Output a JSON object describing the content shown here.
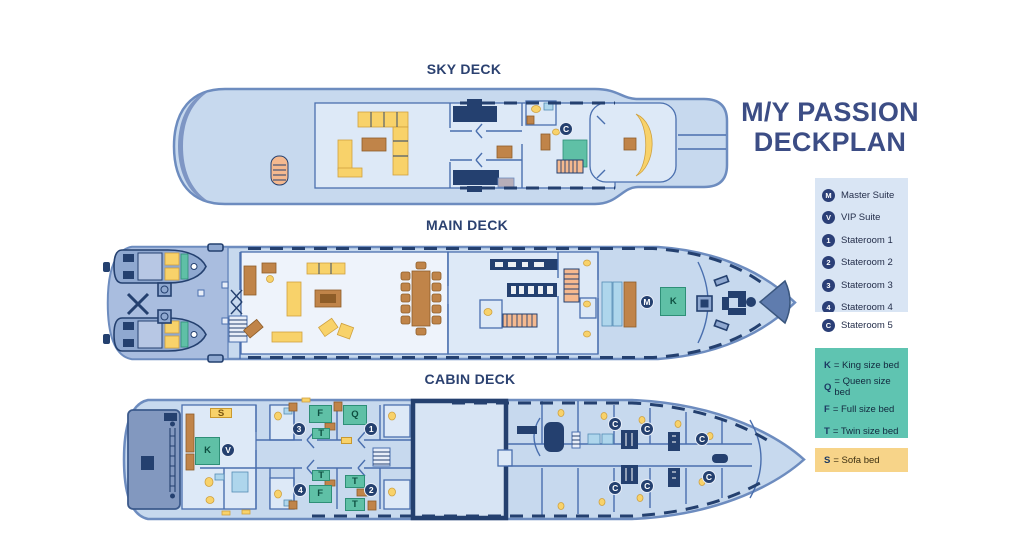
{
  "title": {
    "line1": "M/Y PASSION",
    "line2": "DECKPLAN"
  },
  "decks": [
    {
      "label": "SKY DECK"
    },
    {
      "label": "MAIN DECK"
    },
    {
      "label": "CABIN DECK"
    }
  ],
  "legend_staterooms": {
    "items": [
      {
        "icon": "M",
        "label": "Master Suite"
      },
      {
        "icon": "V",
        "label": "VIP Suite"
      },
      {
        "icon": "1",
        "label": "Stateroom 1"
      },
      {
        "icon": "2",
        "label": "Stateroom 2"
      },
      {
        "icon": "3",
        "label": "Stateroom 3"
      },
      {
        "icon": "4",
        "label": "Stateroom 4"
      },
      {
        "icon": "C",
        "label": "Stateroom 5"
      }
    ]
  },
  "legend_beds": {
    "items": [
      {
        "key": "K",
        "text": "= King size bed"
      },
      {
        "key": "Q",
        "text": "= Queen size bed"
      },
      {
        "key": "F",
        "text": "= Full size bed"
      },
      {
        "key": "T",
        "text": "= Twin size bed"
      }
    ]
  },
  "legend_sofa": {
    "key": "S",
    "text": "= Sofa bed"
  },
  "colors": {
    "accent_navy": "#24406f",
    "hull_blue": "#c7d9ee",
    "legend_blue": "#d9e5f4",
    "legend_teal": "#5fc4b1",
    "legend_sand": "#f7d489",
    "bed_teal": "#5fc0a6",
    "sofa_yellow": "#f8d26a"
  },
  "overlays": [
    {
      "deck": "sky",
      "type": "badge",
      "label": "C",
      "x": 70.1,
      "y": 35.2
    },
    {
      "deck": "main",
      "type": "badge",
      "label": "M",
      "x": 78.2,
      "y": 49.2
    },
    {
      "deck": "main",
      "type": "bed",
      "label": "K",
      "x": 80.1,
      "y": 37.7,
      "w": 3.7,
      "h": 22.3
    },
    {
      "deck": "cabin",
      "type": "sofa",
      "label": "S",
      "x": 14.1,
      "y": 11.9,
      "w": 3.2,
      "h": 7.4
    },
    {
      "deck": "cabin",
      "type": "bed",
      "label": "K",
      "x": 11.9,
      "y": 33.3,
      "w": 3.7,
      "h": 20.7
    },
    {
      "deck": "cabin",
      "type": "badge",
      "label": "V",
      "x": 16.7,
      "y": 43.0
    },
    {
      "deck": "cabin",
      "type": "bed",
      "label": "F",
      "x": 28.3,
      "y": 9.6,
      "w": 3.3,
      "h": 13.3
    },
    {
      "deck": "cabin",
      "type": "bed",
      "label": "T",
      "x": 28.8,
      "y": 26.7,
      "w": 2.6,
      "h": 8.1
    },
    {
      "deck": "cabin",
      "type": "badge",
      "label": "3",
      "x": 26.9,
      "y": 27.4
    },
    {
      "deck": "cabin",
      "type": "bed",
      "label": "Q",
      "x": 33.2,
      "y": 9.6,
      "w": 3.5,
      "h": 14.8
    },
    {
      "deck": "cabin",
      "type": "badge",
      "label": "1",
      "x": 37.3,
      "y": 27.4
    },
    {
      "deck": "cabin",
      "type": "sofa",
      "label": "",
      "x": 32.9,
      "y": 33.3,
      "w": 1.7,
      "h": 5.2
    },
    {
      "deck": "cabin",
      "type": "bed",
      "label": "T",
      "x": 28.8,
      "y": 57.8,
      "w": 2.6,
      "h": 8.1
    },
    {
      "deck": "cabin",
      "type": "bed",
      "label": "F",
      "x": 28.3,
      "y": 68.9,
      "w": 3.3,
      "h": 13.3
    },
    {
      "deck": "cabin",
      "type": "badge",
      "label": "4",
      "x": 27.1,
      "y": 72.6
    },
    {
      "deck": "cabin",
      "type": "bed",
      "label": "T",
      "x": 33.5,
      "y": 61.5,
      "w": 2.9,
      "h": 9.6
    },
    {
      "deck": "cabin",
      "type": "bed",
      "label": "T",
      "x": 33.5,
      "y": 78.5,
      "w": 2.9,
      "h": 9.6
    },
    {
      "deck": "cabin",
      "type": "badge",
      "label": "2",
      "x": 37.3,
      "y": 72.6
    },
    {
      "deck": "cabin",
      "type": "badge",
      "label": "C",
      "x": 72.4,
      "y": 23.7
    },
    {
      "deck": "cabin",
      "type": "badge",
      "label": "C",
      "x": 77.0,
      "y": 27.4
    },
    {
      "deck": "cabin",
      "type": "badge",
      "label": "C",
      "x": 84.9,
      "y": 34.8
    },
    {
      "deck": "cabin",
      "type": "badge",
      "label": "C",
      "x": 72.4,
      "y": 71.1
    },
    {
      "deck": "cabin",
      "type": "badge",
      "label": "C",
      "x": 77.0,
      "y": 69.6
    },
    {
      "deck": "cabin",
      "type": "badge",
      "label": "C",
      "x": 85.9,
      "y": 63.0
    }
  ]
}
